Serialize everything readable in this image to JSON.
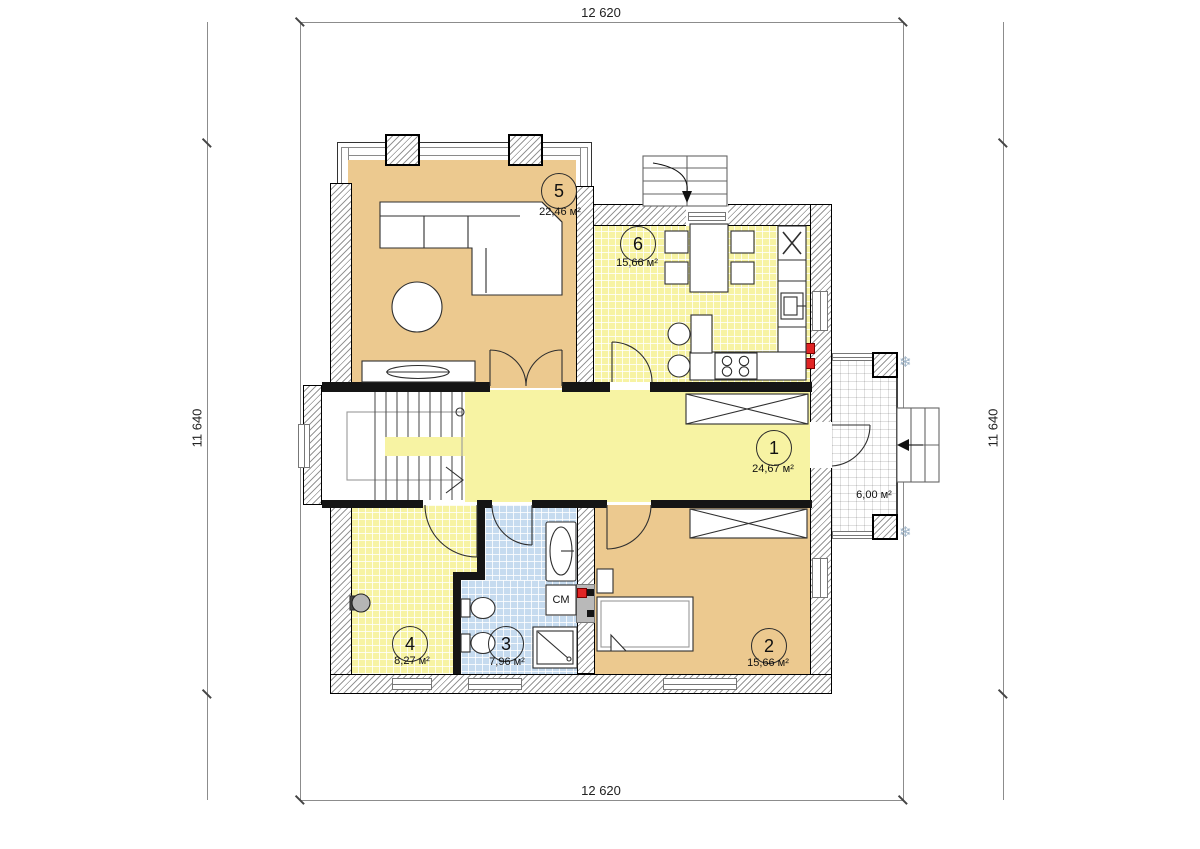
{
  "dimensions": {
    "top": "12 620",
    "bottom": "12 620",
    "left": "11 640",
    "right": "11 640"
  },
  "rooms": {
    "r1": {
      "number": "1",
      "area": "24,67 м²"
    },
    "r2": {
      "number": "2",
      "area": "15,66 м²"
    },
    "r3": {
      "number": "3",
      "area": "7,96 м²"
    },
    "r4": {
      "number": "4",
      "area": "8,27 м²"
    },
    "r5": {
      "number": "5",
      "area": "22,46 м²"
    },
    "r6": {
      "number": "6",
      "area": "15,66 м²"
    },
    "porch": {
      "area": "6,00 м²"
    }
  },
  "labels": {
    "washing_machine": "СМ"
  },
  "icons": {
    "snowflake": "❄"
  },
  "colors": {
    "room_tan": "#ecc98f",
    "room_yellow": "#f7f3a3",
    "room_blue": "#c6dbef",
    "accent_red": "#e02424",
    "wall_hatch": "#969696"
  }
}
